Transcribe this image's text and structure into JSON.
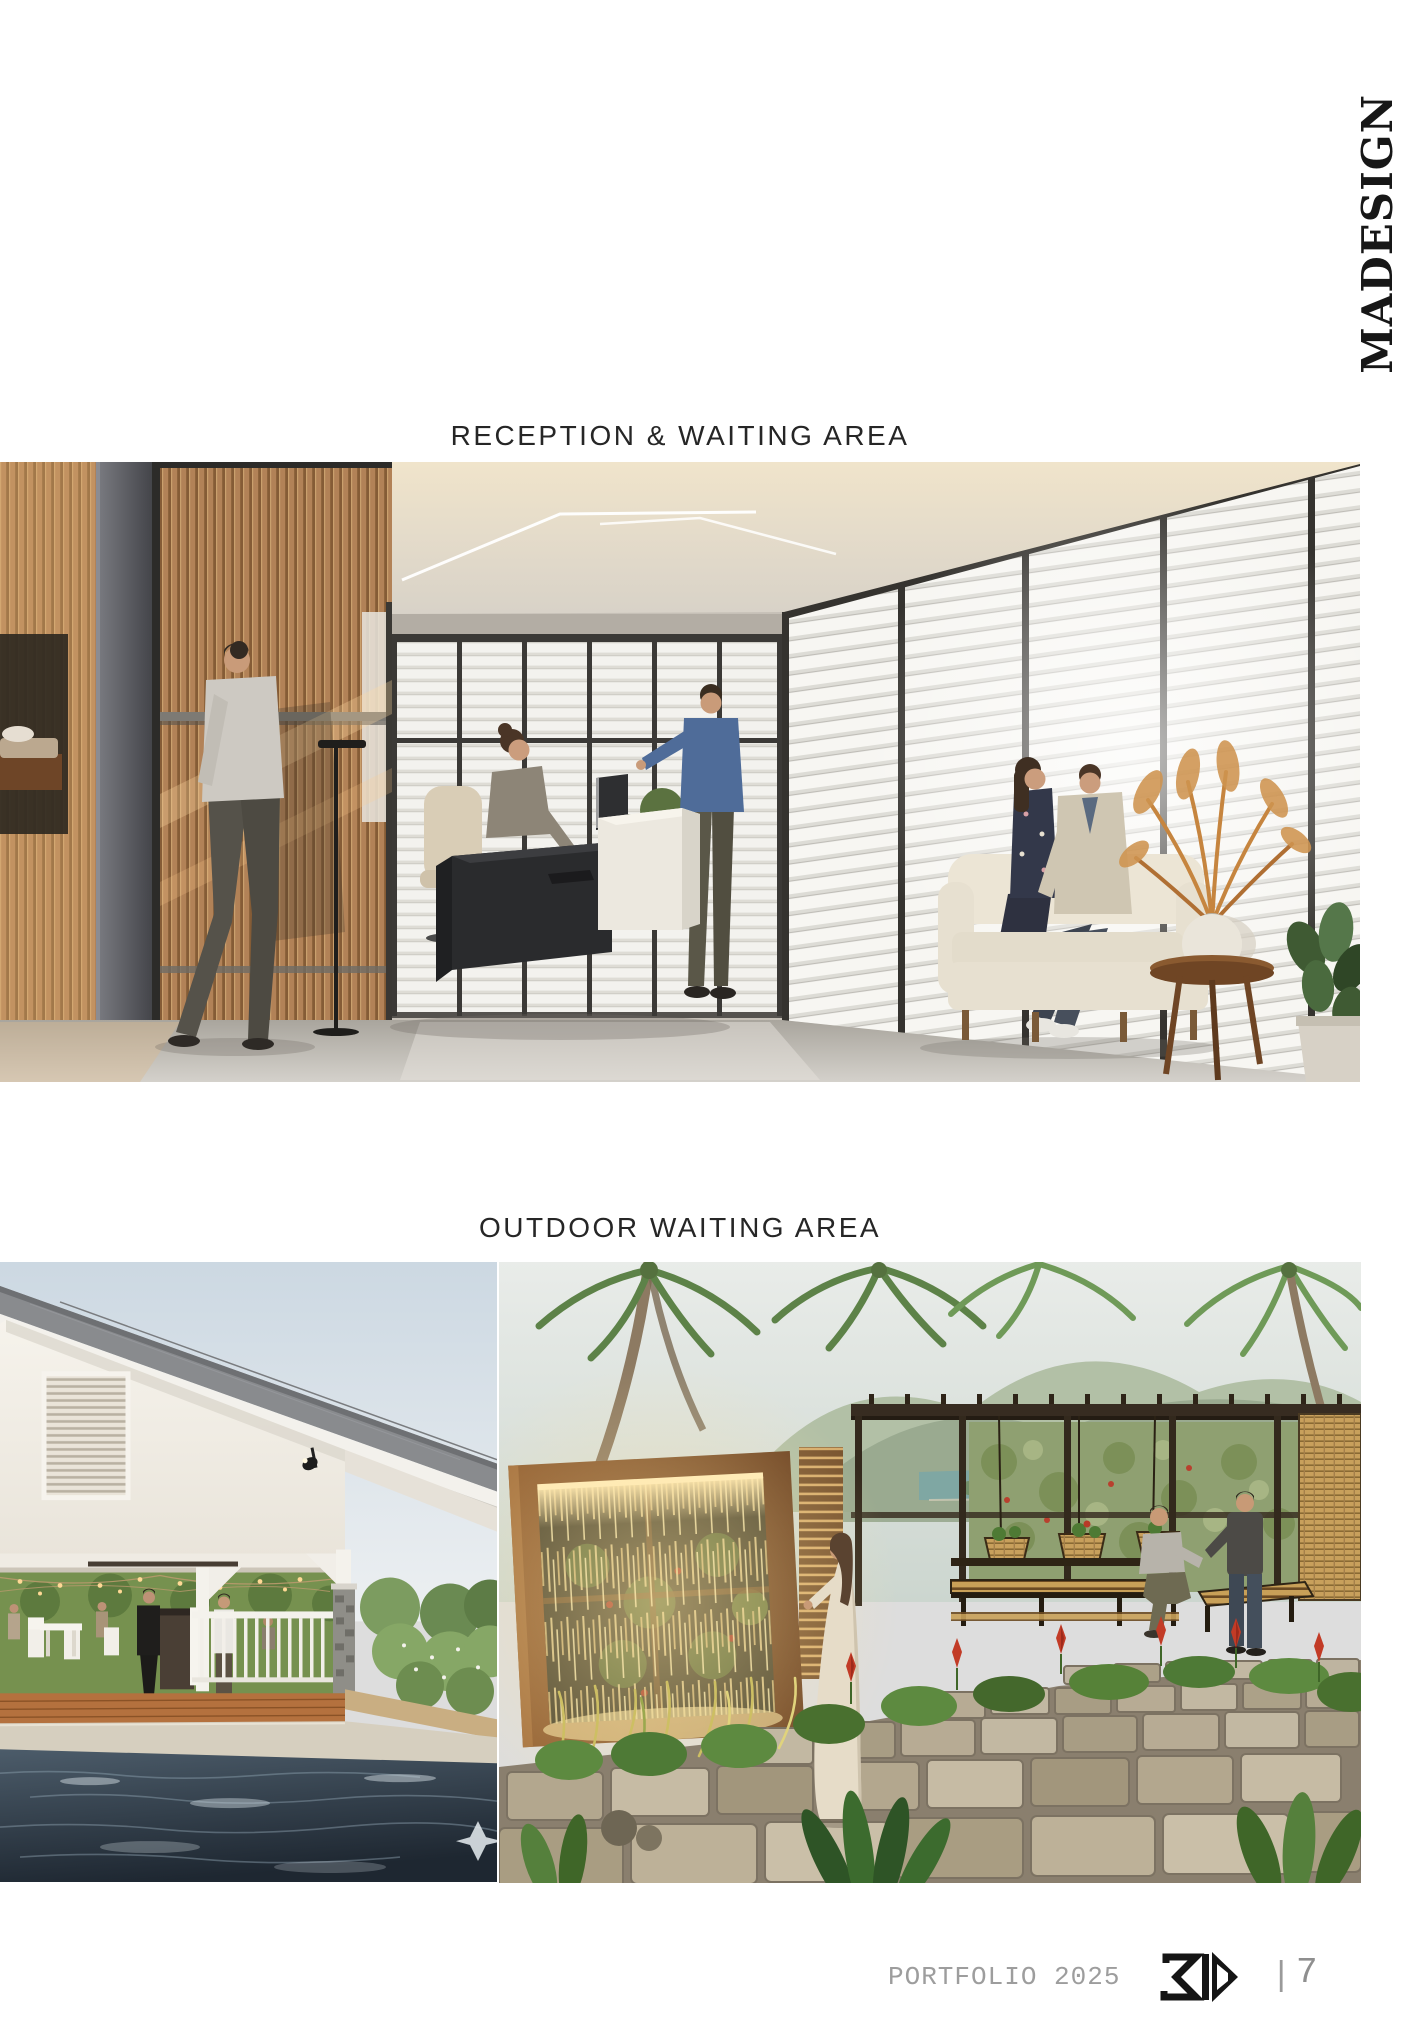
{
  "brand": {
    "vertical_label": "MADESIGN"
  },
  "sections": [
    {
      "heading": "RECEPTION & WAITING AREA",
      "image_alt": "Interior render: wood-slat wall with walking man, dark reception desk with receptionist and standing visitor in blue shirt, louvered glass walls, cream sofa with seated couple, side table with pampas vase and plants"
    },
    {
      "heading": "OUTDOOR WAITING AREA",
      "image_alts": [
        "Exterior render: white gabled pool pavilion with louvered gable vent, string lights, white railing, wooden deck with guests, dark blue swimming pool in foreground",
        "Exterior render: tropical garden waiting area with backlit water-curtain wall in wooden frame, woman in long cream dress, pergola with slatted benches and two men, palm trees, distant bay and stone pavers"
      ]
    }
  ],
  "footer": {
    "portfolio_label": "PORTFOLIO 2025",
    "logo_alt": "3D",
    "separator": "|",
    "page_number": "7"
  },
  "colors": {
    "page_background": "#ffffff",
    "heading_text": "#262626",
    "brand_text": "#171717",
    "footer_text": "#9d9d9d",
    "wood_accent": "#b28257",
    "pool_water": "#2b3642",
    "waterfall_glow": "#ffe9b2"
  }
}
